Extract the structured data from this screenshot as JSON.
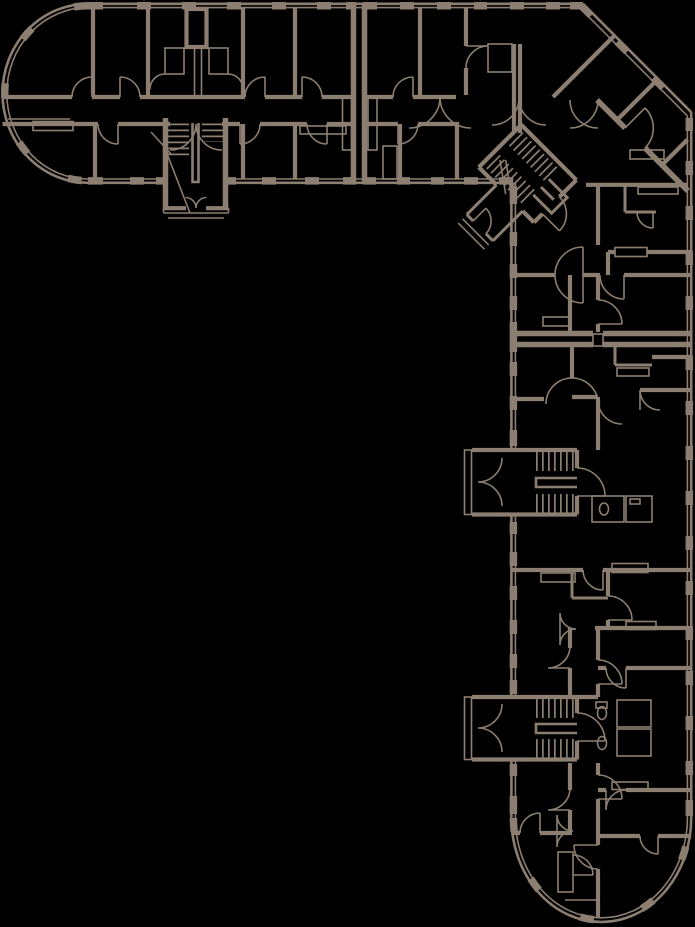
{
  "canvas": {
    "width": 695,
    "height": 927
  },
  "palette": {
    "background": "#000000",
    "line": "#8c7f71"
  },
  "plan": {
    "type": "architectural floor plan",
    "rendering": "tan line drawing on a black background, no text labels",
    "building": "L-shaped residential block",
    "sections": {
      "north_wing": "horizontal wing with a semicircular west bay, central double-flight stairwell and south entrance vestibule with steps",
      "corner_section": "45-degree corner section with a rotated stairwell, entrance porch and diagonal window facade",
      "east_wing": "vertical wing with two west-side stairwells with entrance porches and a semicircular south bay"
    },
    "counts": {
      "stairwells": 4,
      "entrance_porches": 4,
      "expansion_joints": 2,
      "semicircular_bays": 2
    }
  }
}
